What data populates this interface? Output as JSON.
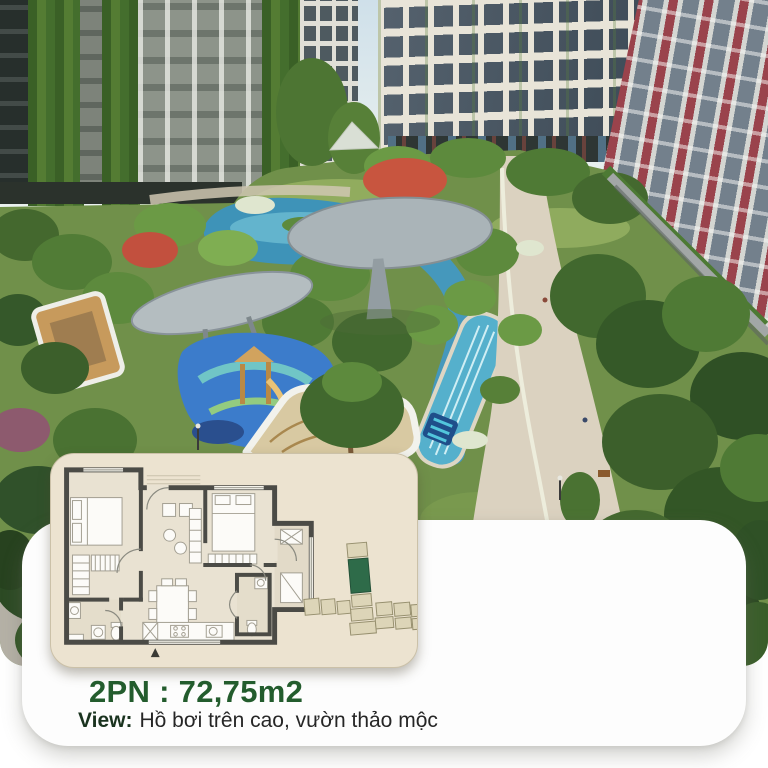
{
  "colors": {
    "page_bg": "#ffffff",
    "accent_green": "#235c2d",
    "text_dark": "#262626",
    "view_label_dark": "#1a331f",
    "card_bg": "#fdfdfd",
    "panel_bg": "#ece3d0",
    "panel_border": "#cbc1a8",
    "floorplan_wall": "#4b4b46",
    "floorplan_floor": "#e9e2d2",
    "highlight_unit_green": "#2e6b49",
    "water_teal": "#3e93b8"
  },
  "card": {
    "area_title": "2PN : 72,75m2",
    "view_label": "View:",
    "view_value": "Hồ bơi trên cao, vườn thảo mộc"
  },
  "floorplan": {
    "bedrooms": "2PN",
    "area_m2": "72,75",
    "entrance_marker": "▲"
  }
}
